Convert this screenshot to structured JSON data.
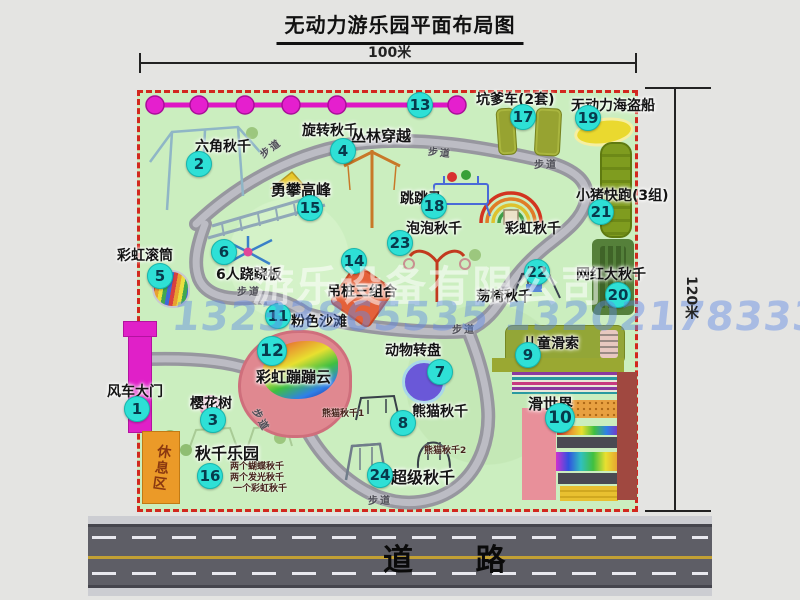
{
  "title": "无动力游乐园平面布局图",
  "dimensions": {
    "width": "100米",
    "height": "120米"
  },
  "road": {
    "label": "道 路"
  },
  "trail_label": "步道",
  "watermark": {
    "company": "游乐设备有限公司",
    "phone": "13233865535 13202178333"
  },
  "rest_area": {
    "label": "休息区"
  },
  "colors": {
    "border_dash": "#d2281e",
    "badge": "#2ee0d6",
    "magenta": "#e020c8",
    "park_green": "#cbeebf",
    "road_gray": "#5e5e66",
    "road_yellow": "#c2a034"
  },
  "attractions": {
    "windmill_gate": {
      "num": "1",
      "label": "风车大门"
    },
    "hex_swing": {
      "num": "2",
      "label": "六角秋千"
    },
    "cherry_tree": {
      "num": "3",
      "label": "樱花树"
    },
    "rotating_swing": {
      "num": "4",
      "label": "旋转秋千"
    },
    "rainbow_roller": {
      "num": "5",
      "label": "彩虹滚筒"
    },
    "seesaw6": {
      "num": "6",
      "label": "6人跷跷板"
    },
    "animal_carousel": {
      "num": "7",
      "label": "动物转盘"
    },
    "panda_swing": {
      "num": "8",
      "label": "熊猫秋千",
      "sub1": "熊猫秋千1",
      "sub2": "熊猫秋千2"
    },
    "kids_zipline": {
      "num": "9",
      "label": "儿童滑索"
    },
    "slide_world": {
      "num": "10",
      "label": "滑世界"
    },
    "pink_beach": {
      "num": "11",
      "label": "粉色沙滩"
    },
    "rainbow_cloud": {
      "num": "12",
      "label": "彩虹蹦蹦云"
    },
    "jungle_crossing": {
      "num": "13",
      "label": "丛林穿越"
    },
    "hanging_piles": {
      "num": "14",
      "label": "吊桩三组合"
    },
    "peak_climb": {
      "num": "15",
      "label": "勇攀高峰"
    },
    "swing_park": {
      "num": "16",
      "label": "秋千乐园",
      "sub1": "两个蝴蝶秋千",
      "sub2": "两个发光秋千",
      "sub3": "一个彩虹秋千"
    },
    "pit_car": {
      "num": "17",
      "label": "坑爹车(2套)"
    },
    "jump_horse": {
      "num": "18",
      "label": "跳跳马"
    },
    "pirate_ship": {
      "num": "19",
      "label": "无动力海盗船"
    },
    "big_swing": {
      "num": "20",
      "label": "网红大秋千"
    },
    "pig_run": {
      "num": "21",
      "label": "小猪快跑(3组)"
    },
    "chair_swing": {
      "num": "22",
      "label": "荡椅秋千"
    },
    "bubble_swing": {
      "num": "23",
      "label": "泡泡秋千"
    },
    "super_swing": {
      "num": "24",
      "label": "超级秋千"
    },
    "rainbow_swing": {
      "label": "彩虹秋千"
    }
  }
}
